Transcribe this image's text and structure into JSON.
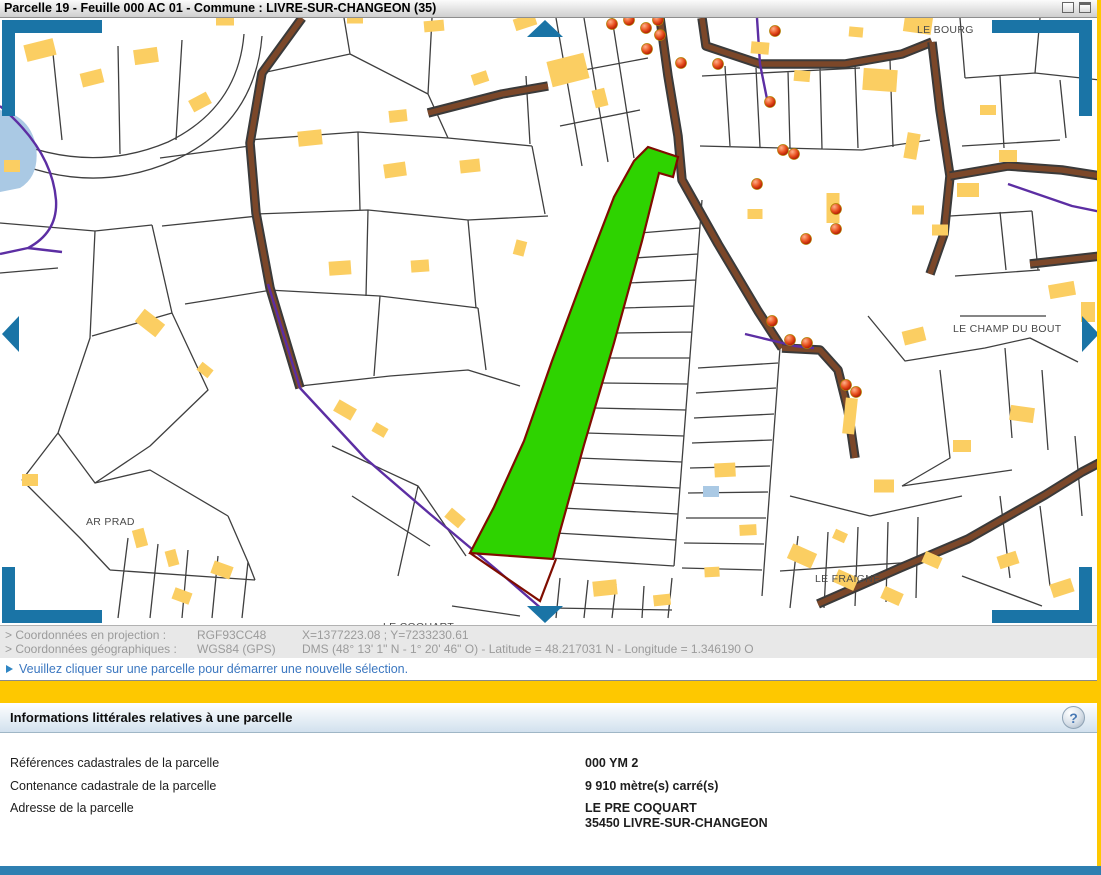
{
  "window": {
    "title": "Parcelle 19 - Feuille 000 AC 01 - Commune : LIVRE-SUR-CHANGEON (35)"
  },
  "map": {
    "place_labels": [
      {
        "text": "LE BOURG",
        "x": 917,
        "y": 15
      },
      {
        "text": "LE CHAMP DU BOUT",
        "x": 953,
        "y": 314
      },
      {
        "text": "AR PRAD",
        "x": 86,
        "y": 507
      },
      {
        "text": "LE COQUART",
        "x": 383,
        "y": 612
      },
      {
        "text": "LE FRAIGNE",
        "x": 815,
        "y": 564
      }
    ],
    "selected_parcel": {
      "reference": "000 YM 2",
      "fill": "#2ed300",
      "outline": "#7f0d00"
    },
    "colors": {
      "building": "#fbce62",
      "road": "#7b4729",
      "road_edge": "#3a3a3a",
      "boundary": "#5c2ea3",
      "parcel_line": "#3f3f3f",
      "marker": "#cc2000",
      "nav_arrow": "#1a74a6",
      "water": "#aac9e4",
      "label": "#4a4a4a"
    }
  },
  "coordinates": {
    "rows": [
      {
        "label": "> Coordonnées en projection :",
        "system": "RGF93CC48",
        "values": "X=1377223.08 ; Y=7233230.61"
      },
      {
        "label": "> Coordonnées géographiques :",
        "system": "WGS84 (GPS)",
        "values": "DMS (48° 13' 1\" N - 1° 20' 46\" O) - Latitude = 48.217031 N - Longitude = 1.346190 O"
      }
    ]
  },
  "message_bar": {
    "text": "Veuillez cliquer sur une parcelle pour démarrer une nouvelle sélection."
  },
  "info_panel": {
    "title": "Informations littérales relatives à une parcelle",
    "help_label": "?",
    "rows": [
      {
        "label": "Références cadastrales de la parcelle",
        "value": "000 YM 2"
      },
      {
        "label": "Contenance cadastrale de la parcelle",
        "value": "9 910 mètre(s) carré(s)"
      },
      {
        "label": "Adresse de la parcelle",
        "value_lines": [
          "LE PRE COQUART",
          "35450 LIVRE-SUR-CHANGEON"
        ]
      }
    ]
  }
}
